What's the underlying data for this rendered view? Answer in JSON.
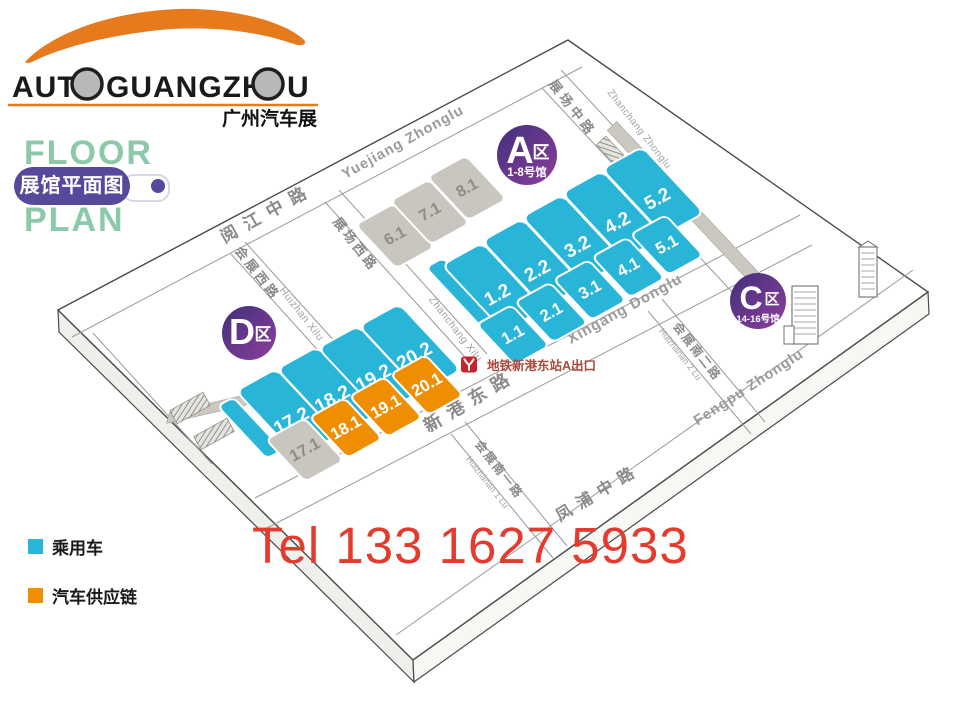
{
  "logo": {
    "part1": "AUT",
    "part2": "GUANGZH",
    "part3": "U",
    "subtitle": "广州汽车展",
    "accent_color": "#e87a1e"
  },
  "floor_plan_title": {
    "line1": "FLOOR",
    "line2": "PLAN",
    "badge": "展馆平面图",
    "green": "#8cc9a9",
    "purple": "#56489a"
  },
  "legend": {
    "items": [
      {
        "label": "乘用车",
        "color": "#29b5d8",
        "category": "passenger"
      },
      {
        "label": "汽车供应链",
        "color": "#ef8e00",
        "category": "supply"
      }
    ]
  },
  "contact": {
    "tel": "Tel 133 1627 5933",
    "color": "#e53a2e"
  },
  "map": {
    "colors": {
      "passenger": "#29b5d8",
      "supply": "#ef8e00",
      "general": "#c9c6bf",
      "general_text": "#8f8c84",
      "zone_grad_start": "#40307a",
      "zone_grad_end": "#8d3e9d",
      "metro_red": "#c4242b",
      "metro_text": "#a8493c"
    },
    "zones": [
      {
        "id": "A",
        "letter": "A",
        "suffix": "区",
        "sub": "1-8号馆"
      },
      {
        "id": "C",
        "letter": "C",
        "suffix": "区",
        "sub": "14-16号馆"
      },
      {
        "id": "D",
        "letter": "D",
        "suffix": "区",
        "sub": ""
      }
    ],
    "halls": [
      {
        "id": "1.1",
        "category": "passenger"
      },
      {
        "id": "2.1",
        "category": "passenger"
      },
      {
        "id": "3.1",
        "category": "passenger"
      },
      {
        "id": "4.1",
        "category": "passenger"
      },
      {
        "id": "5.1",
        "category": "passenger"
      },
      {
        "id": "1.2",
        "category": "passenger"
      },
      {
        "id": "2.2",
        "category": "passenger"
      },
      {
        "id": "3.2",
        "category": "passenger"
      },
      {
        "id": "4.2",
        "category": "passenger"
      },
      {
        "id": "5.2",
        "category": "passenger"
      },
      {
        "id": "6.1",
        "category": "general"
      },
      {
        "id": "7.1",
        "category": "general"
      },
      {
        "id": "8.1",
        "category": "general"
      },
      {
        "id": "17.2",
        "category": "passenger"
      },
      {
        "id": "18.2",
        "category": "passenger"
      },
      {
        "id": "19.2",
        "category": "passenger"
      },
      {
        "id": "20.2",
        "category": "passenger"
      },
      {
        "id": "17.1",
        "category": "general"
      },
      {
        "id": "18.1",
        "category": "supply"
      },
      {
        "id": "19.1",
        "category": "supply"
      },
      {
        "id": "20.1",
        "category": "supply"
      }
    ],
    "streets": [
      {
        "id": "yuejiang-cn",
        "text": "阅江中路"
      },
      {
        "id": "yuejiang-en",
        "text": "Yuejiang Zhonglu"
      },
      {
        "id": "zhanchang-zhonglu-cn",
        "text": "展场中路"
      },
      {
        "id": "zhanchang-zhonglu-en",
        "text": "Zhanchang Zhonglu"
      },
      {
        "id": "zhanchang-xilu-cn",
        "text": "展场西路"
      },
      {
        "id": "zhanchang-xilu-en",
        "text": "Zhanchang Xilu"
      },
      {
        "id": "huizhan-xilu-cn",
        "text": "会展西路"
      },
      {
        "id": "huizhan-xilu-en",
        "text": "Huizhan Xilu"
      },
      {
        "id": "xingang-donglu-en",
        "text": "Xingang Donglu"
      },
      {
        "id": "xingang-donglu-cn",
        "text": "新港东路"
      },
      {
        "id": "huizhanan-1-cn",
        "text": "会展南一路"
      },
      {
        "id": "huizhanan-1-en",
        "text": "Huizhanan 1 Lu"
      },
      {
        "id": "huizhanan-2-cn",
        "text": "会展南二路"
      },
      {
        "id": "huizhanan-2-en",
        "text": "Huizhanan 2 Lu"
      },
      {
        "id": "fengpu-cn",
        "text": "凤浦中路"
      },
      {
        "id": "fengpu-en",
        "text": "Fengpu Zhonglu"
      }
    ],
    "metro": {
      "label": "地铁新港东站A出口"
    }
  }
}
